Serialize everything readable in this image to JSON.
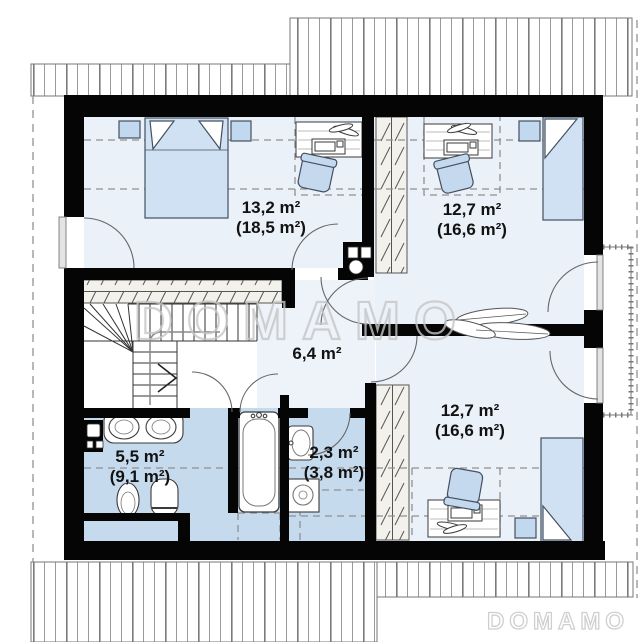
{
  "watermark": {
    "center_text": "DOMAMO",
    "corner_text": "DOMAMO"
  },
  "rooms": [
    {
      "name": "bedroom-top-left",
      "area": "13,2 m²",
      "total_area": "(18,5 m²)"
    },
    {
      "name": "bedroom-top-right",
      "area": "12,7 m²",
      "total_area": "(16,6 m²)"
    },
    {
      "name": "hall",
      "area": "6,4 m²",
      "total_area": ""
    },
    {
      "name": "bathroom",
      "area": "5,5 m²",
      "total_area": "(9,1 m²)"
    },
    {
      "name": "wc",
      "area": "2,3 m²",
      "total_area": "(3,8 m²)"
    },
    {
      "name": "bedroom-bottom-right",
      "area": "12,7 m²",
      "total_area": "(16,6 m²)"
    }
  ],
  "colors": {
    "wall": "#050505",
    "bedroom_floor": "#ebf1f9",
    "hall_floor": "#eef2f9",
    "wet_room_floor": "#c6daee",
    "furniture_blue": "#cfe1f3",
    "closet_fill": "#f3f1ec",
    "roof_hatch_line": "#8c8c8c",
    "watermark_gray": "#c6c6c6"
  }
}
